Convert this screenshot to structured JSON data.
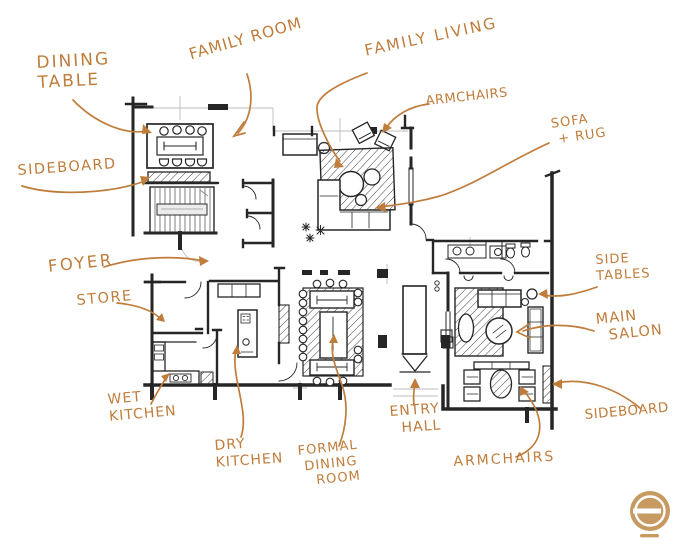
{
  "annotations": {
    "dining_table": {
      "text": "DINING\nTABLE"
    },
    "family_room": {
      "text": "FAMILY ROOM"
    },
    "family_living": {
      "text": "FAMILY LIVING"
    },
    "armchairs_top": {
      "text": "ARMCHAIRS"
    },
    "sofa_rug": {
      "text": "SOFA\n + RUG"
    },
    "sideboard_left": {
      "text": "SIDEBOARD"
    },
    "foyer": {
      "text": "FOYER"
    },
    "store": {
      "text": "STORE"
    },
    "wet_kitchen": {
      "text": "WET\nKITCHEN"
    },
    "dry_kitchen": {
      "text": "DRY\nKITCHEN"
    },
    "formal_dining_room": {
      "text": "FORMAL\n DINING\n   ROOM"
    },
    "entry_hall": {
      "text": "ENTRY\n  HALL"
    },
    "armchairs_bottom": {
      "text": "ARMCHAIRS"
    },
    "sideboard_right": {
      "text": "SIDEBOARD"
    },
    "main_salon": {
      "text": "MAIN\n  SALON"
    },
    "side_tables": {
      "text": "SIDE\nTABLES"
    }
  },
  "icons": {
    "logo_mark": "circle-with-horizontal-bar"
  },
  "colors": {
    "annotation_ink": "#bf7d3c",
    "plan_ink": "#262626",
    "logo": "#c79a62",
    "background": "#ffffff"
  }
}
